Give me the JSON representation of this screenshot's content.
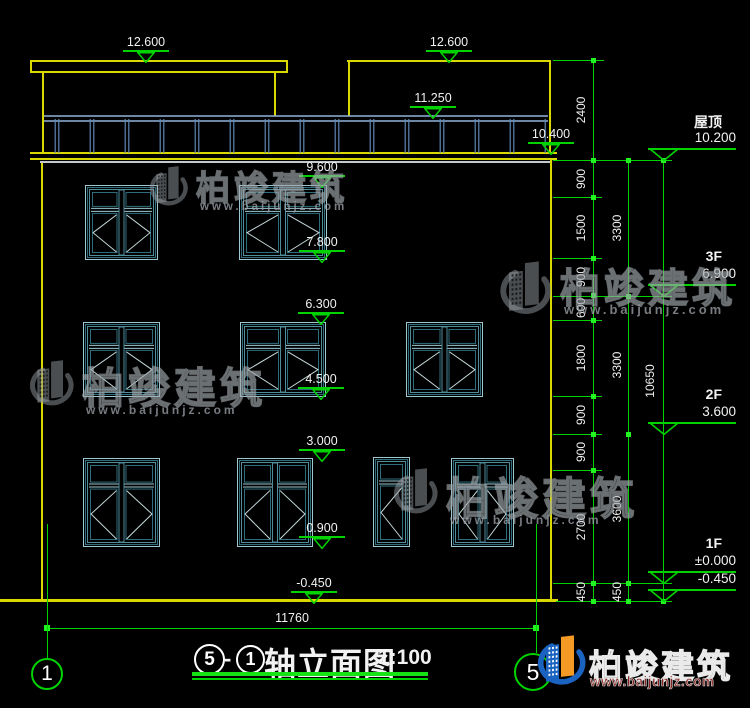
{
  "title_block": {
    "axis_start": "5",
    "dash": "-",
    "axis_end": "1",
    "title": "轴立面图",
    "scale": "1:100"
  },
  "grid": {
    "bubbles": [
      {
        "label": "1",
        "cx": 47,
        "cy": 674,
        "r": 16
      },
      {
        "label": "5",
        "cx": 533,
        "cy": 672,
        "r": 19
      }
    ],
    "lines": [
      {
        "x": 47,
        "y1": 524,
        "y2": 658
      },
      {
        "x": 536,
        "y1": 524,
        "y2": 653
      }
    ]
  },
  "bottom_dimension": {
    "label": "11760",
    "y": 628,
    "x1": 47,
    "x2": 536
  },
  "elevation_markers": [
    {
      "value": "12.600",
      "cx": 146,
      "tip": 60
    },
    {
      "value": "12.600",
      "cx": 449,
      "tip": 60
    },
    {
      "value": "11.250",
      "cx": 433,
      "tip": 116
    },
    {
      "value": "10.400",
      "cx": 551,
      "tip": 152
    },
    {
      "value": "9.600",
      "cx": 322,
      "tip": 185
    },
    {
      "value": "7.800",
      "cx": 322,
      "tip": 260
    },
    {
      "value": "6.300",
      "cx": 321,
      "tip": 322
    },
    {
      "value": "4.500",
      "cx": 321,
      "tip": 397
    },
    {
      "value": "3.000",
      "cx": 322,
      "tip": 459
    },
    {
      "value": "0.900",
      "cx": 322,
      "tip": 546
    },
    {
      "value": "-0.450",
      "cx": 314,
      "tip": 601
    }
  ],
  "floor_markers": [
    {
      "label": "屋顶",
      "value": "10.200",
      "tip": 160
    },
    {
      "label": "3F",
      "value": "6.900",
      "tip": 296
    },
    {
      "label": "2F",
      "value": "3.600",
      "tip": 434
    },
    {
      "label": "1F",
      "value": "±0.000",
      "tip": 583
    },
    {
      "label": "",
      "value": "-0.450",
      "tip": 601
    }
  ],
  "dim_chains": [
    {
      "x": 593,
      "label_dx": -12,
      "ticks": [
        60,
        160,
        197,
        258,
        295,
        320,
        396,
        434,
        470,
        583,
        601
      ],
      "labels": [
        "2400",
        "900",
        "1500",
        "900",
        "600",
        "1800",
        "900",
        "900",
        "2700",
        "450"
      ]
    },
    {
      "x": 628,
      "label_dx": -11,
      "ticks": [
        160,
        296,
        434,
        583,
        601
      ],
      "labels": [
        "3300",
        "3300",
        "3600",
        "450"
      ]
    },
    {
      "x": 663,
      "label_dx": -13,
      "ticks": [
        160,
        601
      ],
      "labels": [
        "10650"
      ]
    }
  ],
  "extension_lines": [
    {
      "y": 60,
      "x1": 553,
      "x2": 604
    },
    {
      "y": 160,
      "x1": 553,
      "x2": 672
    },
    {
      "y": 197,
      "x1": 553,
      "x2": 602
    },
    {
      "y": 258,
      "x1": 553,
      "x2": 602
    },
    {
      "y": 296,
      "x1": 553,
      "x2": 672
    },
    {
      "y": 320,
      "x1": 553,
      "x2": 602
    },
    {
      "y": 396,
      "x1": 553,
      "x2": 602
    },
    {
      "y": 434,
      "x1": 553,
      "x2": 602
    },
    {
      "y": 470,
      "x1": 553,
      "x2": 602
    },
    {
      "y": 583,
      "x1": 553,
      "x2": 672
    },
    {
      "y": 601,
      "x1": 556,
      "x2": 672
    }
  ],
  "windows": [
    {
      "x": 85,
      "y": 185,
      "w": 73,
      "h": 75,
      "panels": 2,
      "t": 0.3
    },
    {
      "x": 239,
      "y": 185,
      "w": 88,
      "h": 75,
      "panels": 2,
      "t": 0.3
    },
    {
      "x": 83,
      "y": 322,
      "w": 77,
      "h": 75,
      "panels": 2,
      "t": 0.3
    },
    {
      "x": 240,
      "y": 322,
      "w": 86,
      "h": 75,
      "panels": 2,
      "t": 0.3
    },
    {
      "x": 406,
      "y": 322,
      "w": 77,
      "h": 75,
      "panels": 2,
      "t": 0.3
    },
    {
      "x": 83,
      "y": 458,
      "w": 77,
      "h": 89,
      "panels": 2,
      "t": 0.28
    },
    {
      "x": 237,
      "y": 458,
      "w": 76,
      "h": 89,
      "panels": 2,
      "t": 0.28
    },
    {
      "x": 373,
      "y": 457,
      "w": 37,
      "h": 90,
      "panels": 1,
      "t": 0.25
    },
    {
      "x": 451,
      "y": 458,
      "w": 63,
      "h": 89,
      "panels": 2,
      "t": 0.28
    }
  ],
  "railing": {
    "x1": 44,
    "x2": 548,
    "top": 115,
    "rail2": 121,
    "bottom": 152,
    "post_start": 57,
    "post_step": 35
  },
  "watermarks": [
    {
      "x": 148,
      "y": 161,
      "lw": 42,
      "f": 34,
      "uf": 11.5
    },
    {
      "x": 498,
      "y": 256,
      "lw": 56,
      "f": 40,
      "uf": 13
    },
    {
      "x": 28,
      "y": 355,
      "lw": 48,
      "f": 42,
      "uf": 12
    },
    {
      "x": 392,
      "y": 463,
      "lw": 48,
      "f": 44,
      "uf": 12
    }
  ],
  "watermark_text": {
    "title": "柏竣建筑",
    "url": "www.baijunjz.com"
  },
  "brand": {
    "title": "柏竣建筑",
    "url": "www.baijunjz.com"
  },
  "colors": {
    "wall": "#d9d900",
    "dim": "#00d300",
    "text": "#f2f2f2",
    "frame_light": "#9cc8d2",
    "frame_dark": "#2e6d7d",
    "frame_mid": "#4f8d9c",
    "diag": "#c4d8da",
    "rail_light": "#8fb3d9",
    "rail_dark": "#5e88b5",
    "slab_soffit": "#c3cacd",
    "logo_blue": "#1a63c0",
    "logo_orange": "#f59b25"
  }
}
